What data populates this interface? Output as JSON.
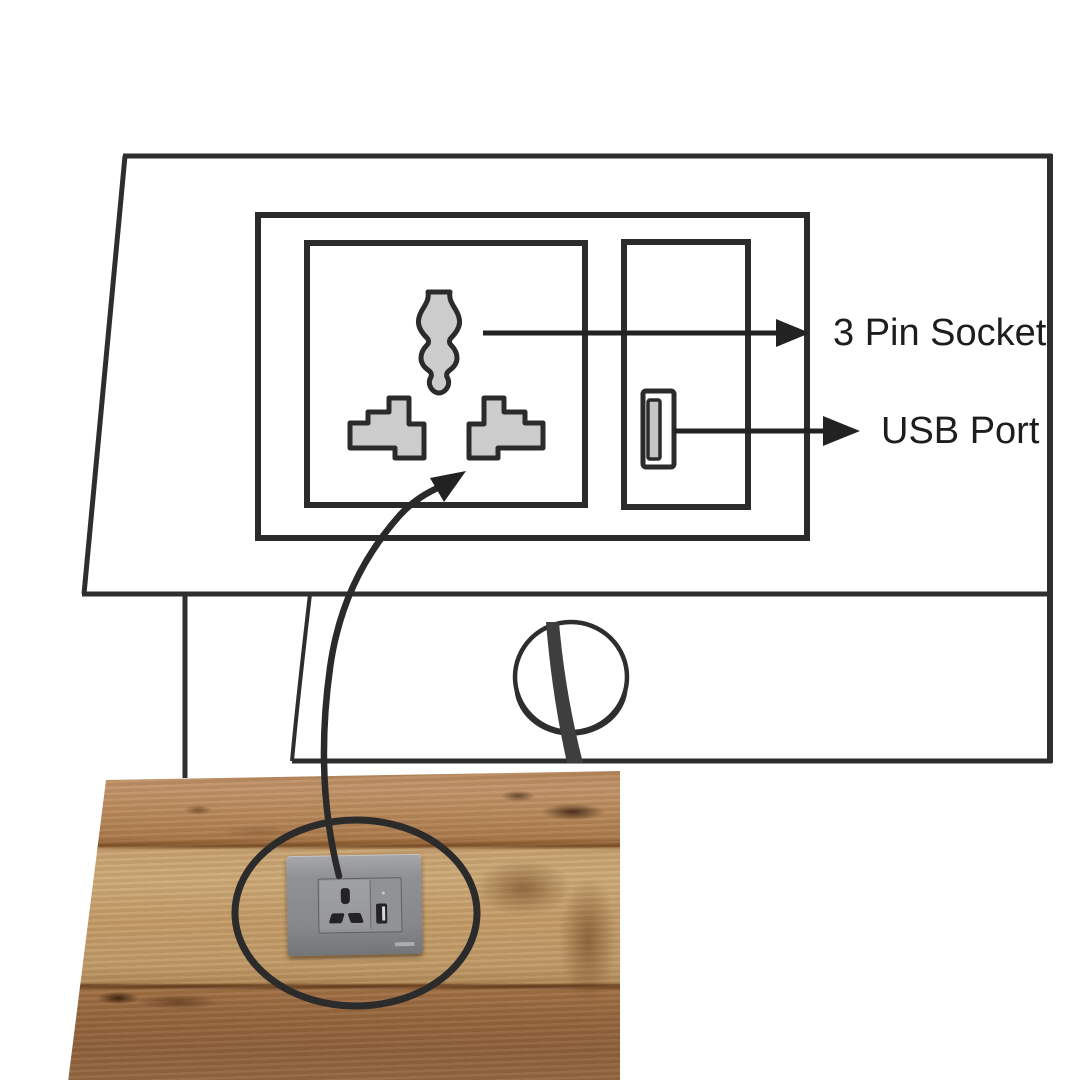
{
  "figure": {
    "type": "product-feature-diagram",
    "subject": "table-top built-in power panel"
  },
  "labels": {
    "socket": "3 Pin Socket",
    "usb": "USB Port"
  },
  "icons": [
    "earth-pin-icon",
    "live-pin-icon",
    "neutral-pin-icon",
    "usb-port-icon",
    "grommet-cable-icon",
    "callout-ellipse",
    "callout-arrow"
  ],
  "colors": {
    "background": "#ffffff",
    "line_art": "#2e2e2e",
    "arrow": "#222222",
    "pin_fill": "#cccccc",
    "cable": "#3e3e3e",
    "plate_gray": "#8b8c8e",
    "wood_light": "#c7a271",
    "wood_dark": "#8d603a",
    "label_text": "#1d1d1d"
  }
}
